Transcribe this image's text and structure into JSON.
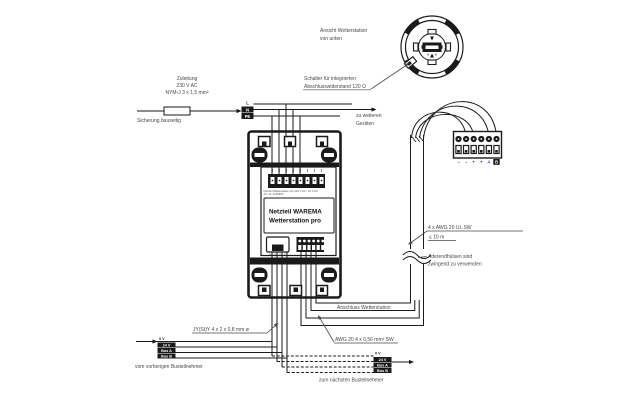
{
  "colors": {
    "background": "#ffffff",
    "ink": "#1a1a1a",
    "label_text": "#474747",
    "accent_blue": "#2f5f9d"
  },
  "callouts": {
    "ansicht_line1": "Ansicht Wetterstation",
    "ansicht_line2": "von unten",
    "schalter_line1": "Schalter für integrierten",
    "schalter_line2": "Abschlusswiderstand 120 Ω",
    "zuleitung_line1": "Zuleitung",
    "zuleitung_line2": "230 V AC",
    "zuleitung_line3": "NYM-J 3 x 1,5 mm²",
    "sicherung": "Sicherung bauseitig",
    "zu_weiteren_line1": "zu weiteren",
    "zu_weiteren_line2": "Geräten",
    "awg_ul_line1": "4 x AWG 20 UL SW",
    "awg_ul_line2": "≤ 10 m",
    "aderendhuelsen_line1": "Aderendhülsen sind",
    "aderendhuelsen_line2": "zwingend zu verwenden",
    "anschluss_wetterstation": "Anschluss Wetterstation",
    "awg_sw": "AWG 20 4 x 0,56 mm² SW",
    "jysty": "JY(St)Y 4 x 2 x 0,8 mm ø",
    "vom_vorherigen": "vom vorherigen Busteilnehmer",
    "zum_naechsten": "zum nächsten Busteilnehmer"
  },
  "device": {
    "name_line1": "Netzteil WAREMA",
    "name_line2": "Wetterstation pro",
    "fine_print_line1": "Netzteil Wetterstation pro 230 V AC / 24 V DC",
    "fine_print_line2": "Art.-Nr. 2039930"
  },
  "mains": {
    "l": "L",
    "n": "N",
    "pe": "PE"
  },
  "bus_labels_left": [
    "0 V",
    "24 V",
    "Bus A",
    "Bus B"
  ],
  "bus_labels_right": [
    "0 V",
    "24 V",
    "Bus A",
    "Bus B"
  ],
  "connector_labels": [
    "−",
    "−",
    "+",
    "+",
    "A",
    "B"
  ]
}
